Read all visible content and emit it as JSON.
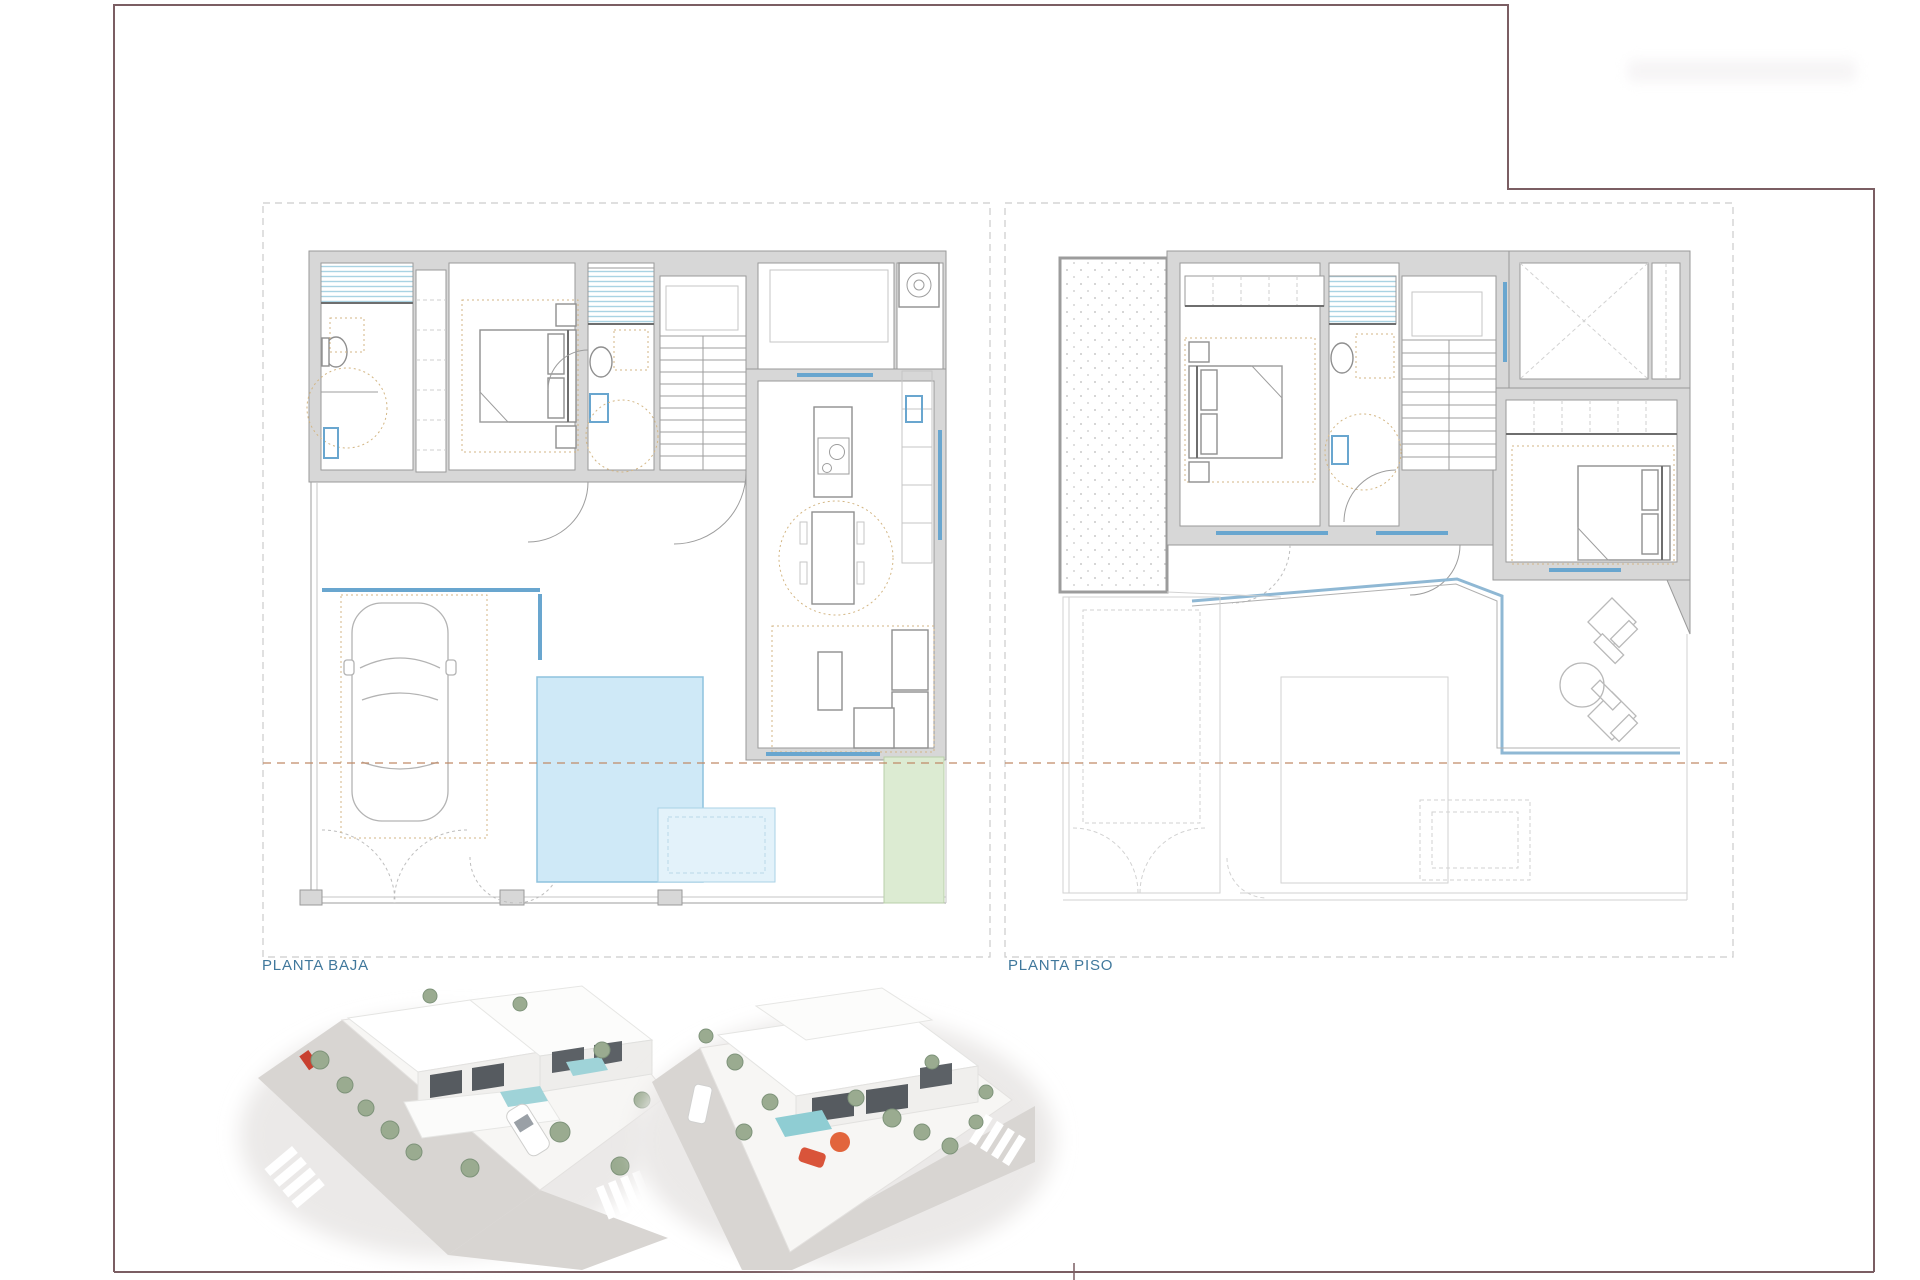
{
  "sheet": {
    "type": "architectural plan sheet",
    "background": "#ffffff",
    "frame_border_color": "#7b5e63"
  },
  "plans": [
    {
      "label": "PLANTA BAJA"
    },
    {
      "label": "PLANTA PISO"
    }
  ],
  "renders": [
    {
      "name": "exterior-aerial-render-1"
    },
    {
      "name": "exterior-aerial-render-2"
    }
  ],
  "colors": {
    "plan_label_text": "#40789c",
    "wall_gray": "#d7d7d7",
    "window_blue": "#69a6cf",
    "shower_stripe_blue": "#a9d3e3",
    "pool_fill": "#cfe9f7",
    "pool_step_fill": "#e3f2fa",
    "lawn_green": "#dcebd2",
    "plot_boundary_dash": "#cccccc",
    "property_line_sienna": "#c08a67",
    "furniture_zone_tan": "#d3b684",
    "street_gray": "#d8d5d2",
    "render_pool_teal": "#8fcdd3",
    "render_accent_orange": "#e2653c"
  }
}
